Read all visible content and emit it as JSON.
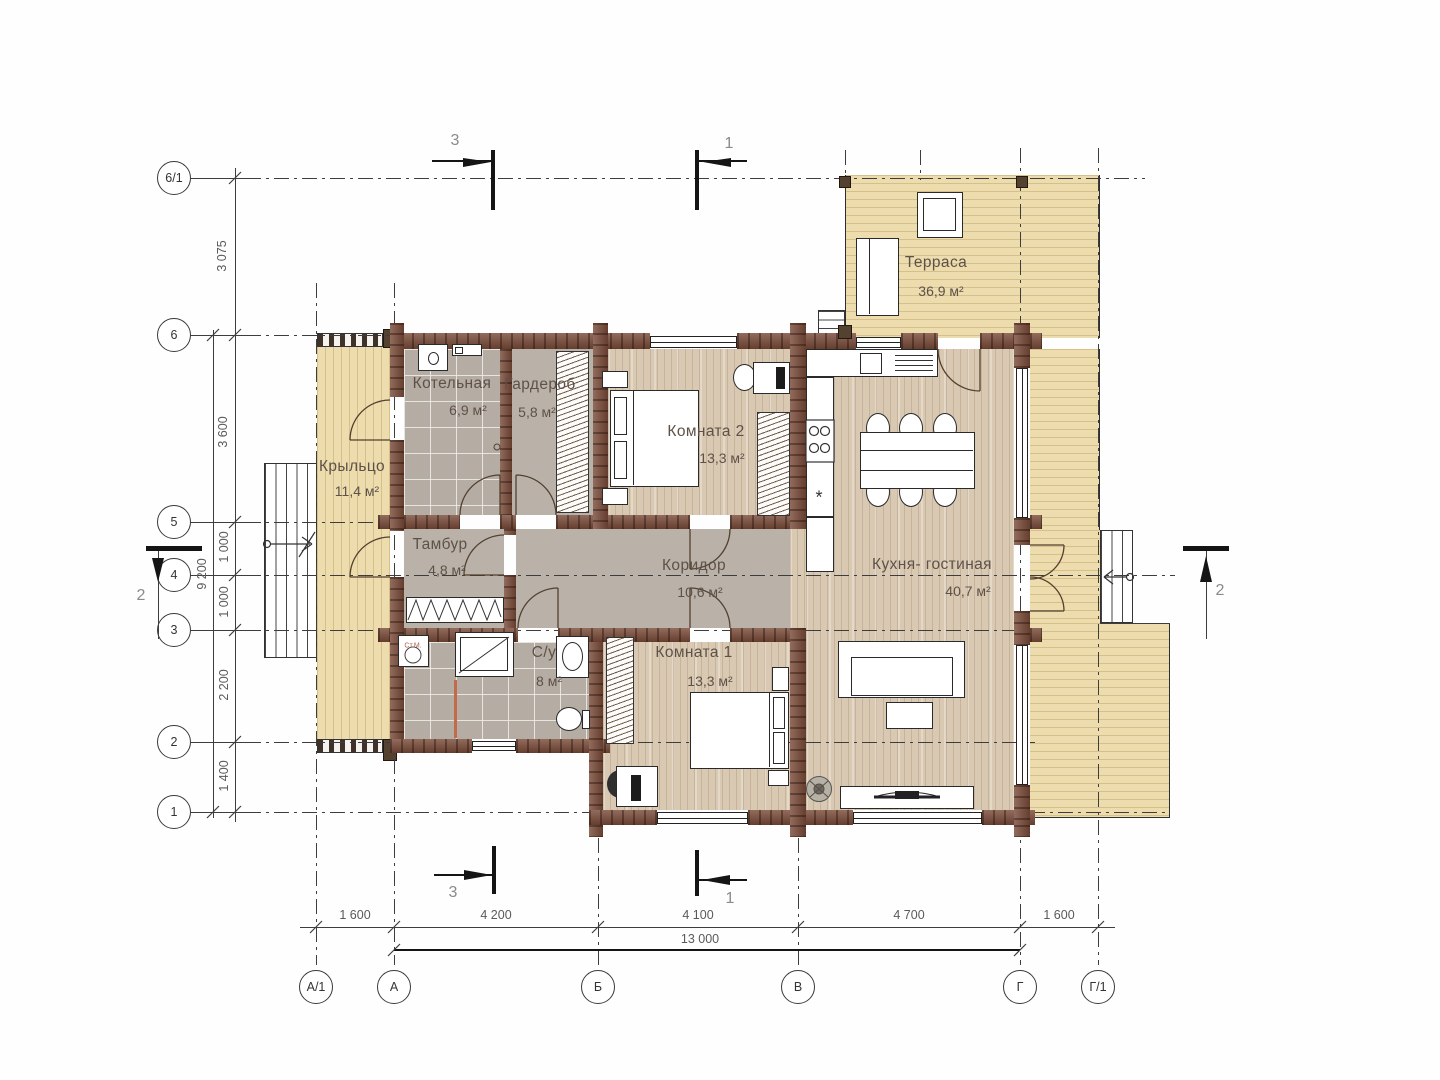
{
  "rooms": {
    "terrace": {
      "name": "Терраса",
      "area": "36,9 м²"
    },
    "boiler": {
      "name": "Котельная",
      "area": "6,9 м²"
    },
    "dressing": {
      "name": "Гардероб",
      "area": "5,8 м²"
    },
    "room2": {
      "name": "Комната 2",
      "area": "13,3 м²"
    },
    "porch": {
      "name": "Крыльцо",
      "area": "11,4 м²"
    },
    "tambour": {
      "name": "Тамбур",
      "area": "4,8 м²"
    },
    "corridor": {
      "name": "Коридор",
      "area": "10,6 м²"
    },
    "bathroom": {
      "name": "С/у",
      "area": "8 м²"
    },
    "room1": {
      "name": "Комната 1",
      "area": "13,3 м²"
    },
    "kitchen": {
      "name": "Кухня- гостиная",
      "area": "40,7 м²"
    }
  },
  "fixtures": {
    "washing_machine": "Ст.М.",
    "vent_mark": "*"
  },
  "axes": {
    "rows": [
      "6/1",
      "6",
      "5",
      "4",
      "3",
      "2",
      "1"
    ],
    "cols": [
      "А/1",
      "А",
      "Б",
      "В",
      "Г",
      "Г/1"
    ]
  },
  "dims": {
    "left": [
      "3 075",
      "3 600",
      "1 000",
      "1 000",
      "2 200",
      "1 400"
    ],
    "left_total": "9 200",
    "bottom": [
      "1 600",
      "4 200",
      "4 100",
      "4 700",
      "1 600"
    ],
    "bottom_total": "13 000"
  },
  "sections": {
    "top_left": "3",
    "top_right": "1",
    "bottom_left": "3",
    "bottom_right": "1",
    "left": "2",
    "right": "2"
  },
  "colors": {
    "wall": "#7a4b38",
    "deck": "#ecdcae",
    "wood_floor": "#d9c9b3",
    "tile_floor": "#b5aca4",
    "corridor_floor": "#bab2a9"
  }
}
